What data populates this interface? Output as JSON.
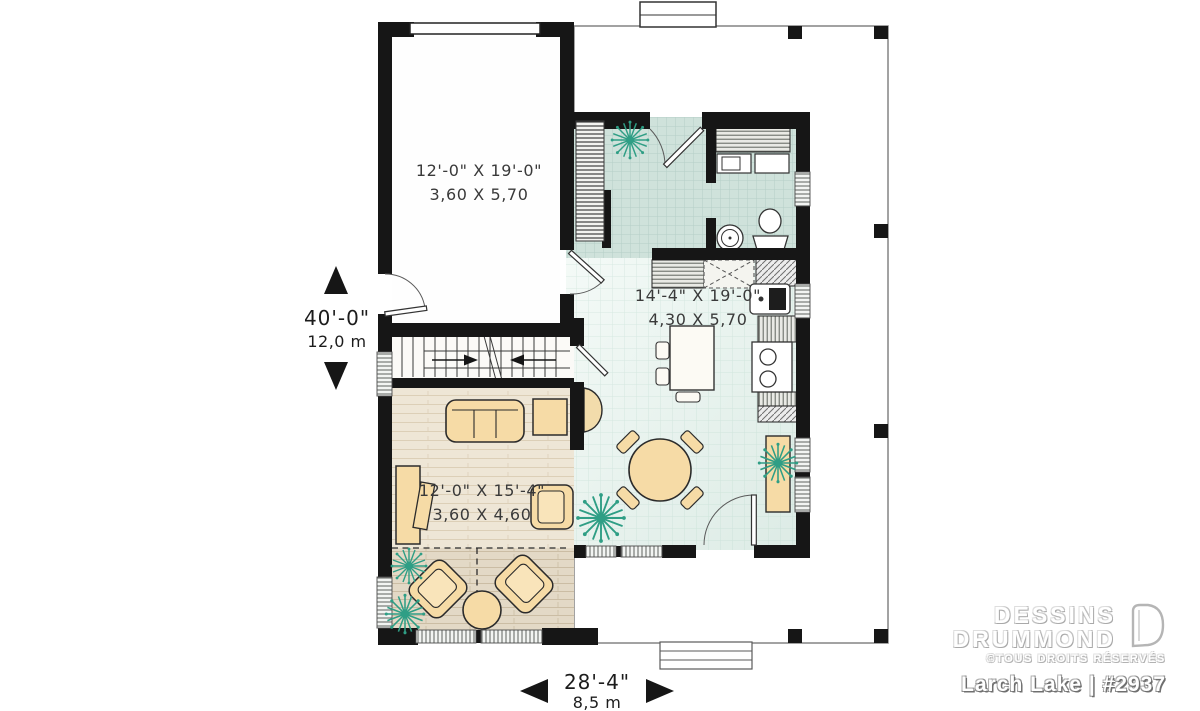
{
  "plan": {
    "rooms": {
      "garage": {
        "imperial": "12'-0\" X 19'-0\"",
        "metric": "3,60 X 5,70"
      },
      "kitchen": {
        "imperial": "14'-4\" X 19'-0\"",
        "metric": "4,30 X 5,70"
      },
      "living": {
        "imperial": "12'-0\" X 15'-4\"",
        "metric": "3,60 X 4,60"
      }
    },
    "overall_depth": {
      "imperial": "40'-0\"",
      "metric": "12,0 m"
    },
    "overall_width": {
      "imperial": "28'-4\"",
      "metric": "8,5 m"
    }
  },
  "branding": {
    "brand_line1": "DESSINS",
    "brand_line2": "DRUMMOND",
    "rights": "©TOUS DROITS RÉSERVÉS",
    "plan_name": "Larch Lake | #2937"
  },
  "colors": {
    "wall": "#161616",
    "tile_floor": "#cfe2db",
    "kitchen_floor": "#e6f1ec",
    "wood_floor": "#eee6d6",
    "terrace_floor": "#e3d9c6",
    "furniture_tan": "#f6dba6",
    "plant_green": "#2f9e85",
    "window_gray": "#6c6f6c"
  }
}
